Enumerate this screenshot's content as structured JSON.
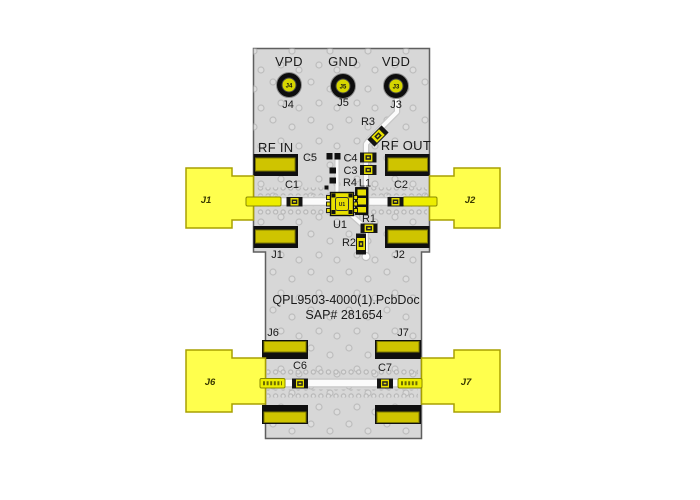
{
  "title": {
    "line1": "QPL9503-4000(1).PcbDoc",
    "line2": "SAP# 281654"
  },
  "power_pins": [
    {
      "net": "VPD",
      "ref": "J4"
    },
    {
      "net": "GND",
      "ref": "J5"
    },
    {
      "net": "VDD",
      "ref": "J3"
    }
  ],
  "rf": {
    "input": "RF IN",
    "output": "RF OUT"
  },
  "connectors": {
    "j1": "J1",
    "j2": "J2",
    "j6": "J6",
    "j7": "J7"
  },
  "components": {
    "c1": "C1",
    "c2": "C2",
    "c3": "C3",
    "c4": "C4",
    "c5": "C5",
    "c6": "C6",
    "c7": "C7",
    "r1": "R1",
    "r2": "R2",
    "r3": "R3",
    "r4": "R4",
    "l1": "L1",
    "u1": "U1"
  },
  "colors": {
    "board_fill": "#d7d7d7",
    "board_stroke": "#5f5f5f",
    "trace_white": "#fbfbfb",
    "trace_edge": "#c6c6c6",
    "comp_yellow": "#e8e000",
    "pad_olive": "#cfc400",
    "pin_yellow": "#eded00",
    "connector_yellow": "#ffff4d",
    "connector_stroke": "#a8a000",
    "via_ring": "#b7b7b7",
    "circle_yellow": "#d6d600",
    "text_color": "#1a1a1a"
  }
}
